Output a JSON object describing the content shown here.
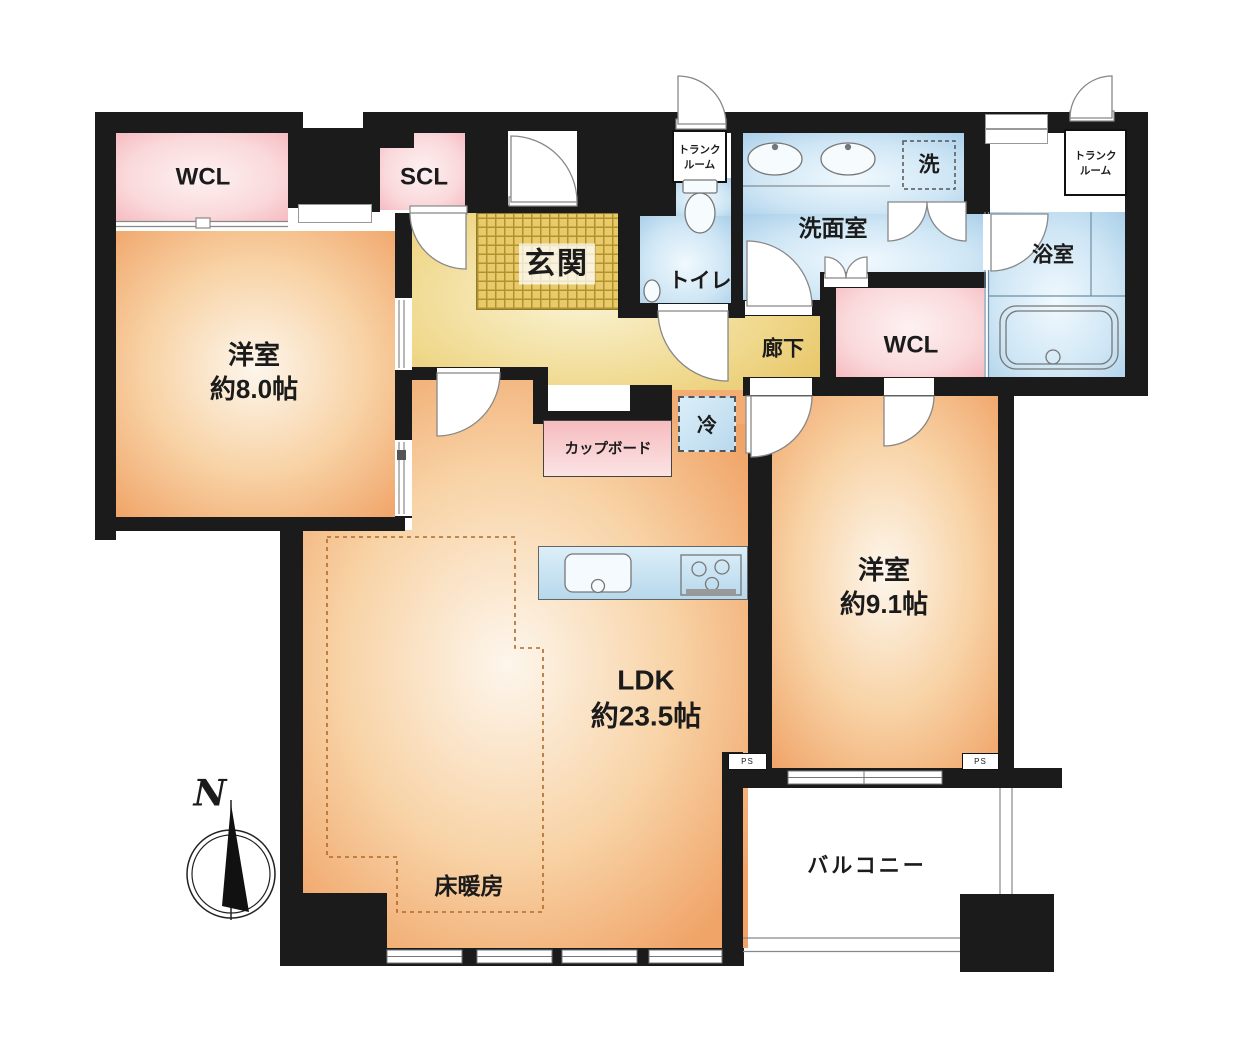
{
  "plan": {
    "title": "apartment-floor-plan",
    "rooms": {
      "wcl_left": {
        "label": "WCL"
      },
      "scl": {
        "label": "SCL"
      },
      "genkan": {
        "label": "玄関"
      },
      "trunk_top": {
        "line1": "トランク",
        "line2": "ルーム"
      },
      "toilet": {
        "label": "トイレ"
      },
      "washroom": {
        "label": "洗面室"
      },
      "washer": {
        "label": "洗"
      },
      "bathroom": {
        "label": "浴室"
      },
      "trunk_right": {
        "line1": "トランク",
        "line2": "ルーム"
      },
      "wcl_right": {
        "label": "WCL"
      },
      "hallway": {
        "label": "廊下"
      },
      "refrigerator": {
        "label": "冷"
      },
      "cupboard": {
        "label": "カップボード"
      },
      "bedroom_left": {
        "name": "洋室",
        "size": "約8.0帖"
      },
      "bedroom_right": {
        "name": "洋室",
        "size": "約9.1帖"
      },
      "ldk": {
        "name": "LDK",
        "size": "約23.5帖"
      },
      "floor_heating": {
        "label": "床暖房"
      },
      "balcony": {
        "label": "バルコニー"
      },
      "ps_left": {
        "label": "PS"
      },
      "ps_right": {
        "label": "PS"
      }
    },
    "compass": {
      "label": "N"
    }
  },
  "colors": {
    "wall": "#1b1b1b",
    "line": "#777777",
    "orange_deep": "#f0a468",
    "orange_mid": "#f8d3a6",
    "orange_pale": "#fdf6ec",
    "yellow_deep": "#e3bd55",
    "yellow_pale": "#faf3d4",
    "hatch_line": "#b1922f",
    "hatch_bg": "#e9ca6b",
    "blue_deep": "#a3cbe7",
    "blue_pale": "#f0f9fe",
    "pink_deep": "#f4b1b7",
    "pink_pale": "#fdf1f2",
    "text": "#1b1b1b"
  }
}
